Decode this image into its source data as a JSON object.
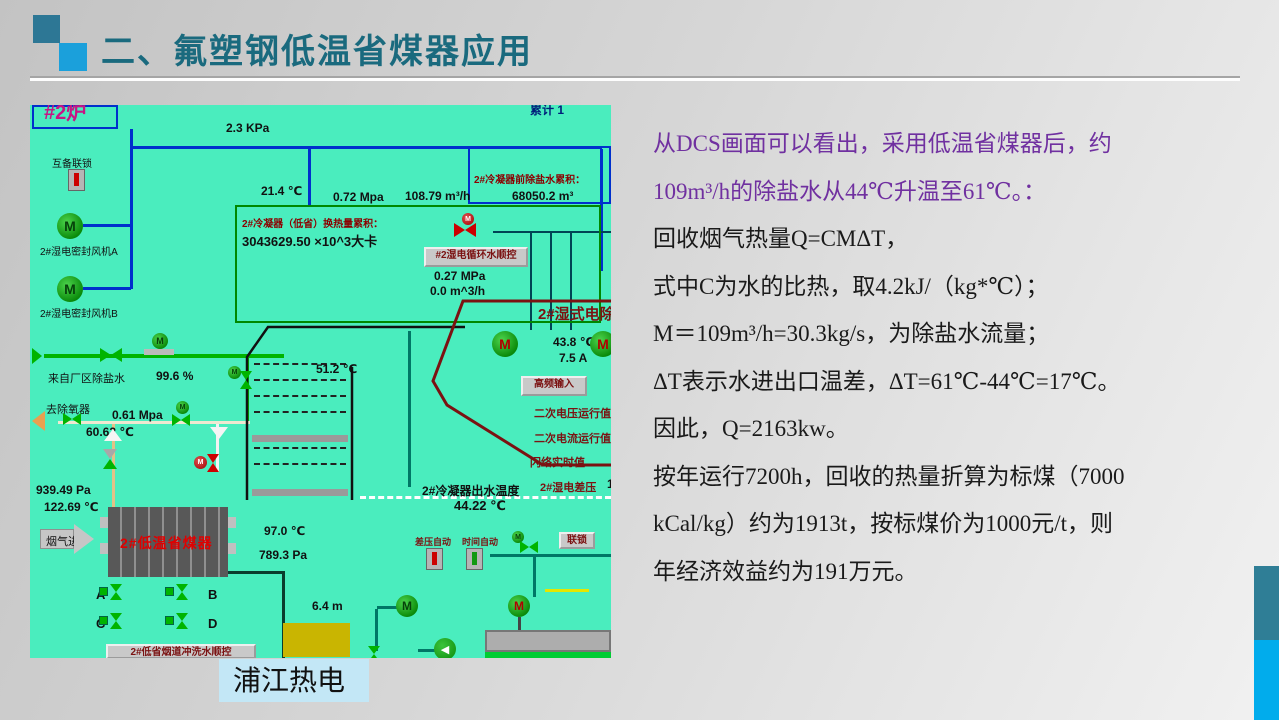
{
  "header": {
    "title": "二、氟塑钢低温省煤器应用"
  },
  "body": {
    "lines": [
      {
        "text": "从DCS画面可以看出，采用低温省煤器后，约",
        "purple": true
      },
      {
        "text": "109m³/h的除盐水从44℃升温至61℃。：",
        "purple": true
      },
      {
        "text": "回收烟气热量Q=CMΔT，",
        "purple": false
      },
      {
        "text": "式中C为水的比热，取4.2kJ/（kg*℃）；",
        "purple": false
      },
      {
        "text": "M＝109m³/h=30.3kg/s，为除盐水流量；",
        "purple": false
      },
      {
        "text": "ΔT表示水进出口温差，ΔT=61℃-44℃=17℃。",
        "purple": false
      },
      {
        "text": "因此，Q=2163kw。",
        "purple": false
      },
      {
        "text": "按年运行7200h，回收的热量折算为标煤（7000",
        "purple": false
      },
      {
        "text": "kCal/kg）约为1913t，按标煤价为1000元/t，则",
        "purple": false
      },
      {
        "text": "年经济效益约为191万元。",
        "purple": false
      }
    ]
  },
  "caption": "浦江热电",
  "colors": {
    "accent_teal": "#2F7E96",
    "accent_blue": "#01ACEC",
    "dcs_bg": "#4AEDBE",
    "purple": "#7030A0",
    "title": "#1A6A7E"
  },
  "dcs": {
    "motor_letter": "M",
    "arrow_left_glyph": "◀",
    "labels": [
      {
        "name": "furnace-2-label",
        "text": "#2炉",
        "x": 14,
        "y": -9,
        "cls": "magenta"
      },
      {
        "name": "clipped-top-label",
        "text": "累计 1",
        "x": 500,
        "y": -4,
        "cls": "navy-clip"
      },
      {
        "name": "pressure-2-3kpa",
        "text": "2.3 KPa",
        "x": 196,
        "y": 16,
        "cls": "val"
      },
      {
        "name": "interlock-label",
        "text": "互备联锁",
        "x": 22,
        "y": 50,
        "cls": "lbl-sm"
      },
      {
        "name": "fan-a-label",
        "text": "2#湿电密封风机A",
        "x": 10,
        "y": 138,
        "cls": "lbl-sm"
      },
      {
        "name": "fan-b-label",
        "text": "2#湿电密封风机B",
        "x": 10,
        "y": 200,
        "cls": "lbl-sm"
      },
      {
        "name": "temp-21-4",
        "text": "21.4 ℃",
        "x": 231,
        "y": 79,
        "cls": "val"
      },
      {
        "name": "pressure-0-72",
        "text": "0.72 Mpa",
        "x": 303,
        "y": 85,
        "cls": "val"
      },
      {
        "name": "flow-108-79",
        "text": "108.79 m³/h",
        "x": 375,
        "y": 84,
        "cls": "val"
      },
      {
        "name": "vol-68050",
        "text": "68050.2 m³",
        "x": 482,
        "y": 84,
        "cls": "val"
      },
      {
        "name": "pre-demin-accum-label",
        "text": "2#冷凝器前除盐水累积：",
        "x": 444,
        "y": 66,
        "cls": "dr"
      },
      {
        "name": "heat-accum-label",
        "text": "2#冷凝器（低省）换热量累积：",
        "x": 212,
        "y": 110,
        "cls": "dr"
      },
      {
        "name": "heat-accum-value",
        "text": "3043629.50 ×10^3大卡",
        "x": 212,
        "y": 126,
        "cls": "val-lg"
      },
      {
        "name": "pressure-0-27",
        "text": "0.27 MPa",
        "x": 404,
        "y": 164,
        "cls": "val"
      },
      {
        "name": "flow-0-0",
        "text": "0.0 m^3/h",
        "x": 400,
        "y": 179,
        "cls": "val"
      },
      {
        "name": "wet-esp-title",
        "text": "2#湿式电除尘",
        "x": 508,
        "y": 198,
        "cls": "esp-title"
      },
      {
        "name": "temp-43-8",
        "text": "43.8 ℃",
        "x": 523,
        "y": 230,
        "cls": "val"
      },
      {
        "name": "current-7-5",
        "text": "7.5 A",
        "x": 529,
        "y": 246,
        "cls": "val"
      },
      {
        "name": "secondary-voltage-label",
        "text": "二次电压运行值",
        "x": 504,
        "y": 300,
        "cls": "dr2"
      },
      {
        "name": "secondary-current-label",
        "text": "二次电流运行值",
        "x": 504,
        "y": 325,
        "cls": "dr2"
      },
      {
        "name": "flashover-label",
        "text": "闪络实时值",
        "x": 500,
        "y": 349,
        "cls": "dr2"
      },
      {
        "name": "esp-dp-label",
        "text": "2#湿电差压",
        "x": 510,
        "y": 374,
        "cls": "dr2"
      },
      {
        "name": "esp-dp-value",
        "text": "1",
        "x": 577,
        "y": 372,
        "cls": "val"
      },
      {
        "name": "temp-51-2",
        "text": "51.2 ℃",
        "x": 286,
        "y": 257,
        "cls": "val"
      },
      {
        "name": "demin-from-plant-label",
        "text": "来自厂区除盐水",
        "x": 18,
        "y": 265,
        "cls": "lbl"
      },
      {
        "name": "valve-open-99-6",
        "text": "99.6 %",
        "x": 126,
        "y": 264,
        "cls": "val"
      },
      {
        "name": "to-deaerator-label",
        "text": "去除氧器",
        "x": 16,
        "y": 296,
        "cls": "lbl"
      },
      {
        "name": "pressure-0-61",
        "text": "0.61 Mpa",
        "x": 82,
        "y": 303,
        "cls": "val"
      },
      {
        "name": "temp-60-62",
        "text": "60.62 ℃",
        "x": 56,
        "y": 320,
        "cls": "val"
      },
      {
        "name": "pressure-939-49",
        "text": "939.49 Pa",
        "x": 6,
        "y": 378,
        "cls": "val"
      },
      {
        "name": "temp-122-69",
        "text": "122.69 ℃",
        "x": 14,
        "y": 395,
        "cls": "val"
      },
      {
        "name": "flue-gas-in-label",
        "text": "烟气进",
        "x": 16,
        "y": 428,
        "cls": "lbl"
      },
      {
        "name": "economizer-label",
        "text": "2#低温省煤器",
        "x": 90,
        "y": 428,
        "cls": "eco"
      },
      {
        "name": "temp-97-0",
        "text": "97.0 ℃",
        "x": 234,
        "y": 419,
        "cls": "val"
      },
      {
        "name": "pressure-789-3",
        "text": "789.3 Pa",
        "x": 229,
        "y": 443,
        "cls": "val"
      },
      {
        "name": "valve-a-label",
        "text": "A",
        "x": 66,
        "y": 482,
        "cls": "val-lg"
      },
      {
        "name": "valve-b-label",
        "text": "B",
        "x": 178,
        "y": 482,
        "cls": "val-lg"
      },
      {
        "name": "valve-c-label",
        "text": "C",
        "x": 66,
        "y": 511,
        "cls": "val-lg"
      },
      {
        "name": "valve-d-label",
        "text": "D",
        "x": 178,
        "y": 511,
        "cls": "val-lg"
      },
      {
        "name": "condenser-outlet-temp-label",
        "text": "2#冷凝器出水温度",
        "x": 392,
        "y": 377,
        "cls": "lbl-b"
      },
      {
        "name": "temp-44-22",
        "text": "44.22 ℃",
        "x": 424,
        "y": 393,
        "cls": "val-lg"
      },
      {
        "name": "dp-auto-label",
        "text": "差压自动",
        "x": 385,
        "y": 430,
        "cls": "dr2s"
      },
      {
        "name": "time-auto-label",
        "text": "时间自动",
        "x": 432,
        "y": 430,
        "cls": "dr2s"
      },
      {
        "name": "level-6-4",
        "text": "6.4 m",
        "x": 282,
        "y": 494,
        "cls": "val"
      }
    ],
    "buttons": [
      {
        "name": "circ-water-seq-button",
        "label": "#2湿电循环水顺控",
        "x": 394,
        "y": 142,
        "w": 104,
        "h": 20
      },
      {
        "name": "hf-input-button",
        "label": "高频输入",
        "x": 491,
        "y": 271,
        "w": 66,
        "h": 20
      },
      {
        "name": "interlock-button",
        "label": "联锁",
        "x": 529,
        "y": 427,
        "w": 36,
        "h": 17
      },
      {
        "name": "flush-seq-button",
        "label": "2#低省烟道冲洗水顺控",
        "x": 76,
        "y": 539,
        "w": 150,
        "h": 15
      }
    ],
    "motors": [
      {
        "name": "fan-a-motor",
        "x": 27,
        "y": 108,
        "d": 26,
        "m": "#06420a"
      },
      {
        "name": "fan-b-motor",
        "x": 27,
        "y": 171,
        "d": 26,
        "m": "#06420a"
      },
      {
        "name": "esp-motor",
        "x": 462,
        "y": 226,
        "d": 26,
        "m": "#b00000"
      },
      {
        "name": "esp-motor-right",
        "x": 560,
        "y": 226,
        "d": 26,
        "m": "#b00000"
      },
      {
        "name": "pump-motor",
        "x": 366,
        "y": 490,
        "d": 22,
        "m": "#06420a"
      },
      {
        "name": "agitator-motor",
        "x": 478,
        "y": 490,
        "d": 22,
        "m": "#b00000"
      },
      {
        "name": "valve-motor-1",
        "x": 122,
        "y": 228,
        "d": 16,
        "m": "#06420a"
      },
      {
        "name": "valve-motor-2",
        "x": 198,
        "y": 261,
        "d": 13,
        "m": "#06420a"
      },
      {
        "name": "valve-motor-3",
        "x": 146,
        "y": 296,
        "d": 13,
        "m": "#06420a"
      },
      {
        "name": "spray-valve-motor",
        "x": 432,
        "y": 108,
        "d": 12,
        "m": "#ffffff",
        "bg": "red"
      },
      {
        "name": "drain-valve-motor",
        "x": 164,
        "y": 351,
        "d": 13,
        "m": "#ffffff",
        "bg": "red"
      },
      {
        "name": "interlock-valve-motor",
        "x": 482,
        "y": 426,
        "d": 12,
        "m": "#06420a"
      }
    ],
    "valves": [
      {
        "name": "demin-inlet-valve",
        "x": 70,
        "y": 243,
        "dir": "h",
        "w": 22,
        "h": 14,
        "c": "#00B400"
      },
      {
        "name": "deaerator-valve",
        "x": 33,
        "y": 308,
        "dir": "h",
        "w": 18,
        "h": 12,
        "c": "#00B400"
      },
      {
        "name": "p061-valve",
        "x": 142,
        "y": 309,
        "dir": "h",
        "w": 18,
        "h": 12,
        "c": "#00B400"
      },
      {
        "name": "esp-spray-valve",
        "x": 424,
        "y": 118,
        "dir": "h",
        "w": 22,
        "h": 14,
        "c": "#CC0000"
      },
      {
        "name": "riser-valve",
        "x": 73,
        "y": 344,
        "dir": "v",
        "w": 14,
        "h": 20,
        "c": "#A8A8A8",
        "c2": "#00B400"
      },
      {
        "name": "drain-valve",
        "x": 177,
        "y": 349,
        "dir": "v",
        "w": 13,
        "h": 18,
        "c": "#CC0000"
      },
      {
        "name": "branch-valve",
        "x": 210,
        "y": 266,
        "dir": "v",
        "w": 13,
        "h": 18,
        "c": "#00B400"
      },
      {
        "name": "interlock-valve",
        "x": 490,
        "y": 436,
        "dir": "h",
        "w": 18,
        "h": 12,
        "c": "#00B400"
      },
      {
        "name": "tank-valve",
        "x": 338,
        "y": 541,
        "dir": "v",
        "w": 13,
        "h": 16,
        "c": "#00B400"
      },
      {
        "name": "valve-a",
        "x": 80,
        "y": 479,
        "dir": "v",
        "w": 12,
        "h": 16,
        "c": "#00B400",
        "sq": true
      },
      {
        "name": "valve-b",
        "x": 146,
        "y": 479,
        "dir": "v",
        "w": 12,
        "h": 16,
        "c": "#00B400",
        "sq": true
      },
      {
        "name": "valve-c",
        "x": 80,
        "y": 508,
        "dir": "v",
        "w": 12,
        "h": 16,
        "c": "#00B400",
        "sq": true
      },
      {
        "name": "valve-d",
        "x": 146,
        "y": 508,
        "dir": "v",
        "w": 12,
        "h": 16,
        "c": "#00B400",
        "sq": true
      }
    ],
    "pipes": [
      {
        "name": "blue-pipe-v1",
        "x": 100,
        "y": 24,
        "w": 3,
        "h": 160,
        "c": "#0030CC"
      },
      {
        "name": "blue-pipe-h1",
        "x": 100,
        "y": 41,
        "w": 472,
        "h": 3,
        "c": "#0030CC"
      },
      {
        "name": "fan-a-stub",
        "x": 53,
        "y": 119,
        "w": 48,
        "h": 3,
        "c": "#0030CC"
      },
      {
        "name": "fan-b-stub",
        "x": 53,
        "y": 182,
        "w": 48,
        "h": 3,
        "c": "#0030CC"
      },
      {
        "name": "blue-pipe-v2",
        "x": 278,
        "y": 44,
        "w": 3,
        "h": 58,
        "c": "#0030CC"
      },
      {
        "name": "blue-pipe-v3",
        "x": 570,
        "y": 44,
        "w": 3,
        "h": 122,
        "c": "#0030CC"
      },
      {
        "name": "green-pipe-h1",
        "x": 14,
        "y": 249,
        "w": 240,
        "h": 4,
        "c": "#00B400"
      },
      {
        "name": "green-pipe-v1",
        "x": 216,
        "y": 251,
        "w": 3,
        "h": 68,
        "c": "#00B400"
      },
      {
        "name": "valve-motor-base",
        "x": 114,
        "y": 244,
        "w": 30,
        "h": 6,
        "c": "#BBBBBB"
      },
      {
        "name": "cream-pipe-h1",
        "x": 28,
        "y": 316,
        "w": 192,
        "h": 3,
        "c": "#EFE8D0"
      },
      {
        "name": "cream-pipe-v1",
        "x": 82,
        "y": 319,
        "w": 3,
        "h": 85,
        "c": "#E2C187"
      },
      {
        "name": "white-pipe-v1",
        "x": 186,
        "y": 319,
        "w": 3,
        "h": 48,
        "c": "#F2F2F2"
      },
      {
        "name": "teal-pipe-v1",
        "x": 378,
        "y": 226,
        "w": 3,
        "h": 156,
        "c": "#007766"
      },
      {
        "name": "teal-pipe-h2",
        "x": 460,
        "y": 449,
        "w": 121,
        "h": 3,
        "c": "#007766"
      },
      {
        "name": "teal-pipe-v2",
        "x": 503,
        "y": 452,
        "w": 3,
        "h": 40,
        "c": "#007766"
      },
      {
        "name": "teal-pipe-h3",
        "x": 347,
        "y": 501,
        "w": 27,
        "h": 3,
        "c": "#007766"
      },
      {
        "name": "teal-pipe-v3",
        "x": 345,
        "y": 504,
        "w": 3,
        "h": 42,
        "c": "#007766"
      },
      {
        "name": "teal-pipe-h4",
        "x": 388,
        "y": 544,
        "w": 34,
        "h": 3,
        "c": "#007766"
      },
      {
        "name": "tank-top-line",
        "x": 198,
        "y": 466,
        "w": 57,
        "h": 3,
        "c": "#0a3d2e"
      },
      {
        "name": "tank-left-line",
        "x": 252,
        "y": 469,
        "w": 3,
        "h": 84,
        "c": "#0a3d2e"
      },
      {
        "name": "motor-pole",
        "x": 488,
        "y": 512,
        "w": 3,
        "h": 36,
        "c": "#444444"
      },
      {
        "name": "yellow-dash",
        "x": 515,
        "y": 484,
        "w": 44,
        "h": 3,
        "c": "#E6E600"
      },
      {
        "name": "bank-line-top",
        "x": 463,
        "y": 126,
        "w": 118,
        "h": 2,
        "c": "#004455"
      },
      {
        "name": "bank-line-v1",
        "x": 500,
        "y": 128,
        "w": 2,
        "h": 97,
        "c": "#004455"
      },
      {
        "name": "bank-line-v2",
        "x": 520,
        "y": 128,
        "w": 2,
        "h": 97,
        "c": "#004455"
      },
      {
        "name": "bank-line-v3",
        "x": 540,
        "y": 128,
        "w": 2,
        "h": 97,
        "c": "#004455"
      },
      {
        "name": "damper-bar-1",
        "x": 222,
        "y": 330,
        "w": 96,
        "h": 7,
        "c": "#9A9A9A"
      },
      {
        "name": "damper-bar-2",
        "x": 222,
        "y": 384,
        "w": 96,
        "h": 7,
        "c": "#9A9A9A"
      }
    ],
    "boxes": [
      {
        "name": "furnace-box",
        "x": 2,
        "y": 0,
        "w": 86,
        "h": 24,
        "border": "#0030CC"
      },
      {
        "name": "accum-box",
        "x": 438,
        "y": 41,
        "w": 143,
        "h": 58,
        "border": "#0030CC"
      },
      {
        "name": "condenser-box",
        "x": 205,
        "y": 100,
        "w": 366,
        "h": 118,
        "border": "#008800"
      },
      {
        "name": "water-tank",
        "x": 253,
        "y": 518,
        "w": 67,
        "h": 34,
        "bg": "#C9B501"
      },
      {
        "name": "concrete-base",
        "x": 455,
        "y": 525,
        "w": 126,
        "h": 22,
        "border": "#777777",
        "bg": "#ADADAD"
      },
      {
        "name": "ground-strip",
        "x": 455,
        "y": 547,
        "w": 126,
        "h": 6,
        "bg": "#00CC33"
      }
    ],
    "hatches": [
      {
        "name": "tube-hatch-1",
        "x": 224,
        "y": 258,
        "w": 92
      },
      {
        "name": "tube-hatch-2",
        "x": 224,
        "y": 274,
        "w": 92
      },
      {
        "name": "tube-hatch-3",
        "x": 224,
        "y": 290,
        "w": 92
      },
      {
        "name": "tube-hatch-4",
        "x": 224,
        "y": 306,
        "w": 92
      },
      {
        "name": "tube-hatch-5",
        "x": 224,
        "y": 342,
        "w": 92
      },
      {
        "name": "tube-hatch-6",
        "x": 224,
        "y": 358,
        "w": 92
      }
    ],
    "tris": [
      {
        "name": "demin-in-arrow",
        "x": 2,
        "y": 243,
        "dir": "right",
        "s": 8,
        "c": "#00B400"
      },
      {
        "name": "deaerator-arrow",
        "x": 2,
        "y": 306,
        "dir": "left",
        "s": 10,
        "c": "#E8A050"
      },
      {
        "name": "riser-up-arrow",
        "x": 74,
        "y": 324,
        "dir": "up",
        "s": 9,
        "c": "#F5F5F5"
      },
      {
        "name": "drain-down-arrow",
        "x": 180,
        "y": 322,
        "dir": "down",
        "s": 9,
        "c": "#F5F5F5"
      },
      {
        "name": "flue-arrow-head",
        "x": 44,
        "y": 419,
        "dir": "right",
        "s": 15,
        "c": "#C6C6C6"
      }
    ]
  }
}
